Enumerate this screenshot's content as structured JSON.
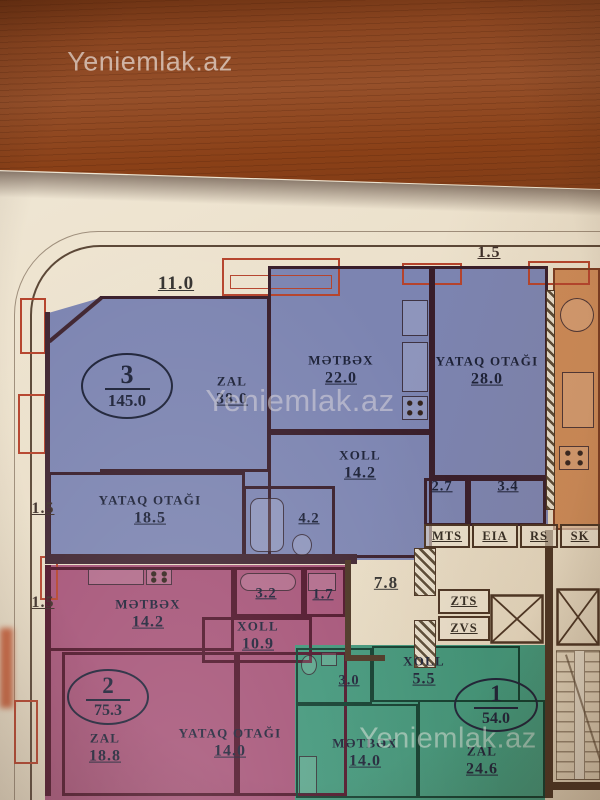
{
  "photo": {
    "watermark_text": "Yeniemlak.az",
    "colors": {
      "wood": "#8a4520",
      "paper": "#ece1cc",
      "apartment_blue": "#7c84b1",
      "apartment_pink": "#a55277",
      "apartment_green": "#3f9579",
      "apartment_orange": "#cd8a57",
      "wall_dark": "#3f2430",
      "balcony_red": "#b5432c",
      "label_ink": "#1b2036"
    }
  },
  "plan": {
    "dimensions": {
      "top_terrace": "11.0",
      "top_right": "1.5",
      "left_upper": "1.5",
      "left_lower": "1.5"
    },
    "apartments": [
      {
        "number": "3",
        "total_area": "145.0",
        "rooms": [
          {
            "name": "ZAL",
            "area": "38.0"
          },
          {
            "name": "MƏTBƏX",
            "area": "22.0"
          },
          {
            "name": "YATAQ OTAĞI",
            "area": "28.0"
          },
          {
            "name": "XOLL",
            "area": "14.2"
          },
          {
            "name": "YATAQ OTAĞI",
            "area": "18.5"
          },
          {
            "name": "",
            "area": "4.2"
          },
          {
            "name": "",
            "area": "2.7"
          },
          {
            "name": "",
            "area": "3.4"
          }
        ]
      },
      {
        "number": "2",
        "total_area": "75.3",
        "rooms": [
          {
            "name": "MƏTBƏX",
            "area": "14.2"
          },
          {
            "name": "XOLL",
            "area": "10.9"
          },
          {
            "name": "",
            "area": "3.2"
          },
          {
            "name": "",
            "area": "1.7"
          },
          {
            "name": "ZAL",
            "area": "18.8"
          },
          {
            "name": "YATAQ OTAĞI",
            "area": "14.0"
          }
        ]
      },
      {
        "number": "1",
        "total_area": "54.0",
        "rooms": [
          {
            "name": "XOLL",
            "area": "5.5"
          },
          {
            "name": "",
            "area": "3.0"
          },
          {
            "name": "MƏTBƏX",
            "area": "14.0"
          },
          {
            "name": "ZAL",
            "area": "24.6"
          }
        ]
      }
    ],
    "core": {
      "corridor_area": "7.8",
      "service_labels": [
        "MTS",
        "EIA",
        "RS",
        "SK"
      ],
      "shaft_labels": [
        "ZTS",
        "ZVS"
      ]
    }
  }
}
